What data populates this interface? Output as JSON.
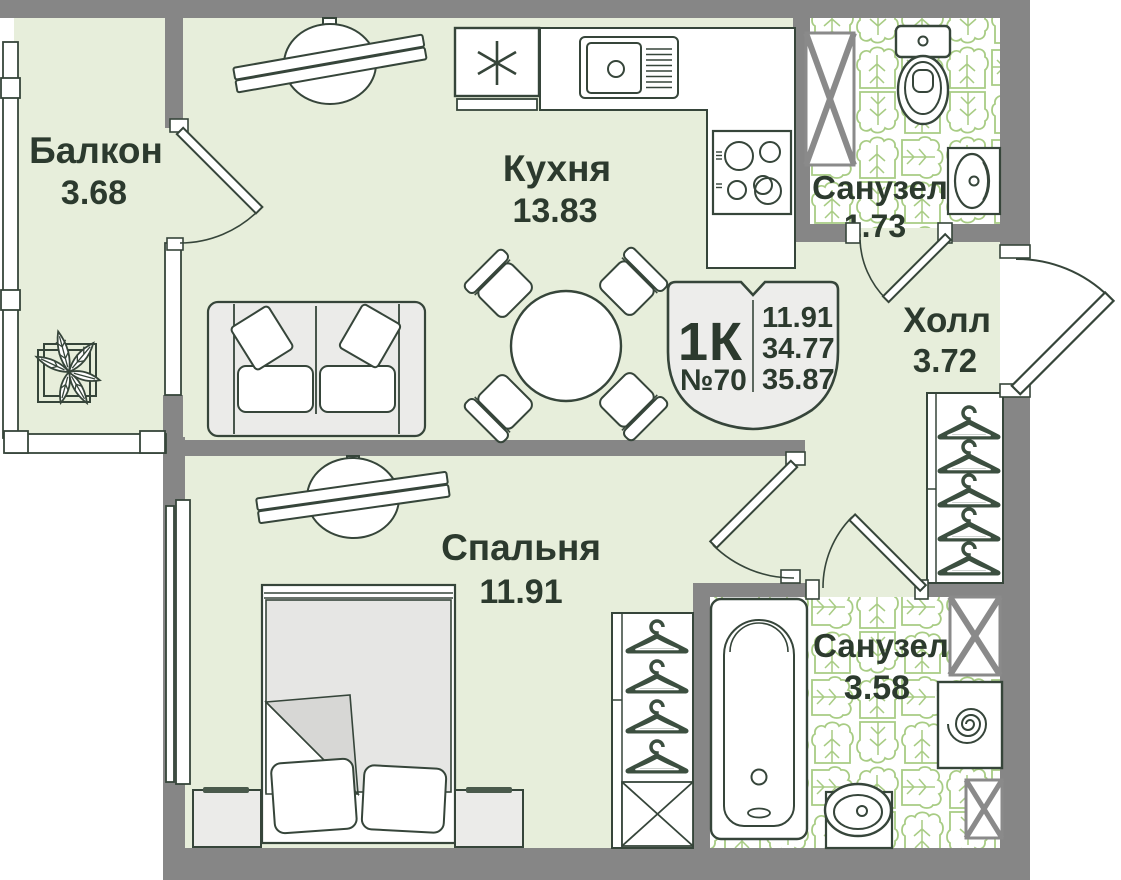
{
  "floorplan": {
    "unit": {
      "type_label": "1К",
      "number": "№70",
      "areas": {
        "living": "11.91",
        "area": "34.77",
        "total": "35.87"
      }
    },
    "rooms": {
      "balcony": {
        "name": "Балкон",
        "area": "3.68"
      },
      "kitchen": {
        "name": "Кухня",
        "area": "13.83"
      },
      "bathroom_top": {
        "name": "Санузел",
        "area": "1.73"
      },
      "hall": {
        "name": "Холл",
        "area": "3.72"
      },
      "bedroom": {
        "name": "Спальня",
        "area": "11.91"
      },
      "bathroom_bottom": {
        "name": "Санузел",
        "area": "3.58"
      }
    },
    "colors": {
      "floor": "#e7eedb",
      "wall": "#868686",
      "line": "#36453a",
      "text": "#2c3a2e",
      "tile": "#a8cc84",
      "furniture_light": "#ebebe9"
    }
  }
}
